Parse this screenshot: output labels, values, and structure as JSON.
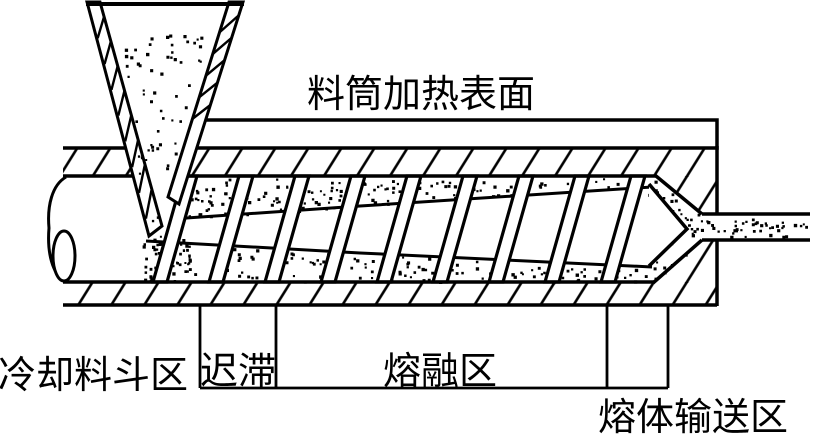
{
  "diagram": {
    "top_label": "料筒加热表面",
    "zones": {
      "cooling_hopper": "冷却料斗区",
      "delay": "迟滞",
      "melting": "熔融区",
      "melt_conveying": "熔体输送区"
    }
  },
  "colors": {
    "ink": "#000000",
    "paper": "#ffffff"
  }
}
